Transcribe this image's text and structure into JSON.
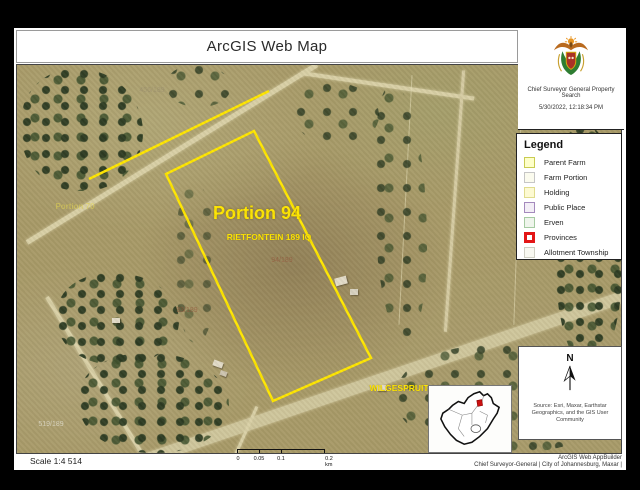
{
  "title": "ArcGIS Web Map",
  "header_panel": {
    "crest_icon": "south-africa-coat-of-arms-icon",
    "org_label": "Chief Surveyor General Property Search",
    "timestamp": "5/30/2022, 12:18:34 PM"
  },
  "legend": {
    "title": "Legend",
    "items": [
      {
        "label": "Parent Farm",
        "swatch_style": "background:#feffc9;border:1px solid #c9cc52"
      },
      {
        "label": "Farm Portion",
        "swatch_style": "background:#fbfbee;border:1px solid #c6c6c6"
      },
      {
        "label": "Holding",
        "swatch_style": "background:#fdfad2;border:1px solid #e0dc8e"
      },
      {
        "label": "Public Place",
        "swatch_style": "background:#f3eef6;border:1px solid #a489bd"
      },
      {
        "label": "Erven",
        "swatch_style": "background:#eff5ec;border:1px solid #a6cba2"
      },
      {
        "label": "Provinces",
        "swatch_style": "background:#ffffff;border:3px solid #e31616"
      },
      {
        "label": "Allotment Township",
        "swatch_style": "background:#f8f8f1;border:1px solid #cfcfc4"
      }
    ]
  },
  "map": {
    "parcel_color": "#ffe600",
    "labels": {
      "portion": "Portion 94",
      "farm_name": "RIETFONTEIN 189 IQ",
      "parcel_code": "94/189",
      "neighbor_farm": "WILGESPRUIT 190 IQ",
      "faint_portion": "Portion 70",
      "faint_code_1": "456/189",
      "faint_code_2": "93/189",
      "faint_code_3": "519/189"
    }
  },
  "north_panel": {
    "north_label": "N",
    "source_text": "Source: Esri, Maxar, Earthstar Geographics, and the GIS User Community"
  },
  "inset": {
    "highlight_color": "#cc1111"
  },
  "footer": {
    "scale_text": "Scale 1:4 514",
    "scalebar_ticks": [
      "0",
      "0.05",
      "0.1",
      "0.2 km"
    ],
    "credit_line1": "ArcGIS Web AppBuilder",
    "credit_line2": "Chief Surveyor-General | City of Johannesburg, Maxar |"
  }
}
